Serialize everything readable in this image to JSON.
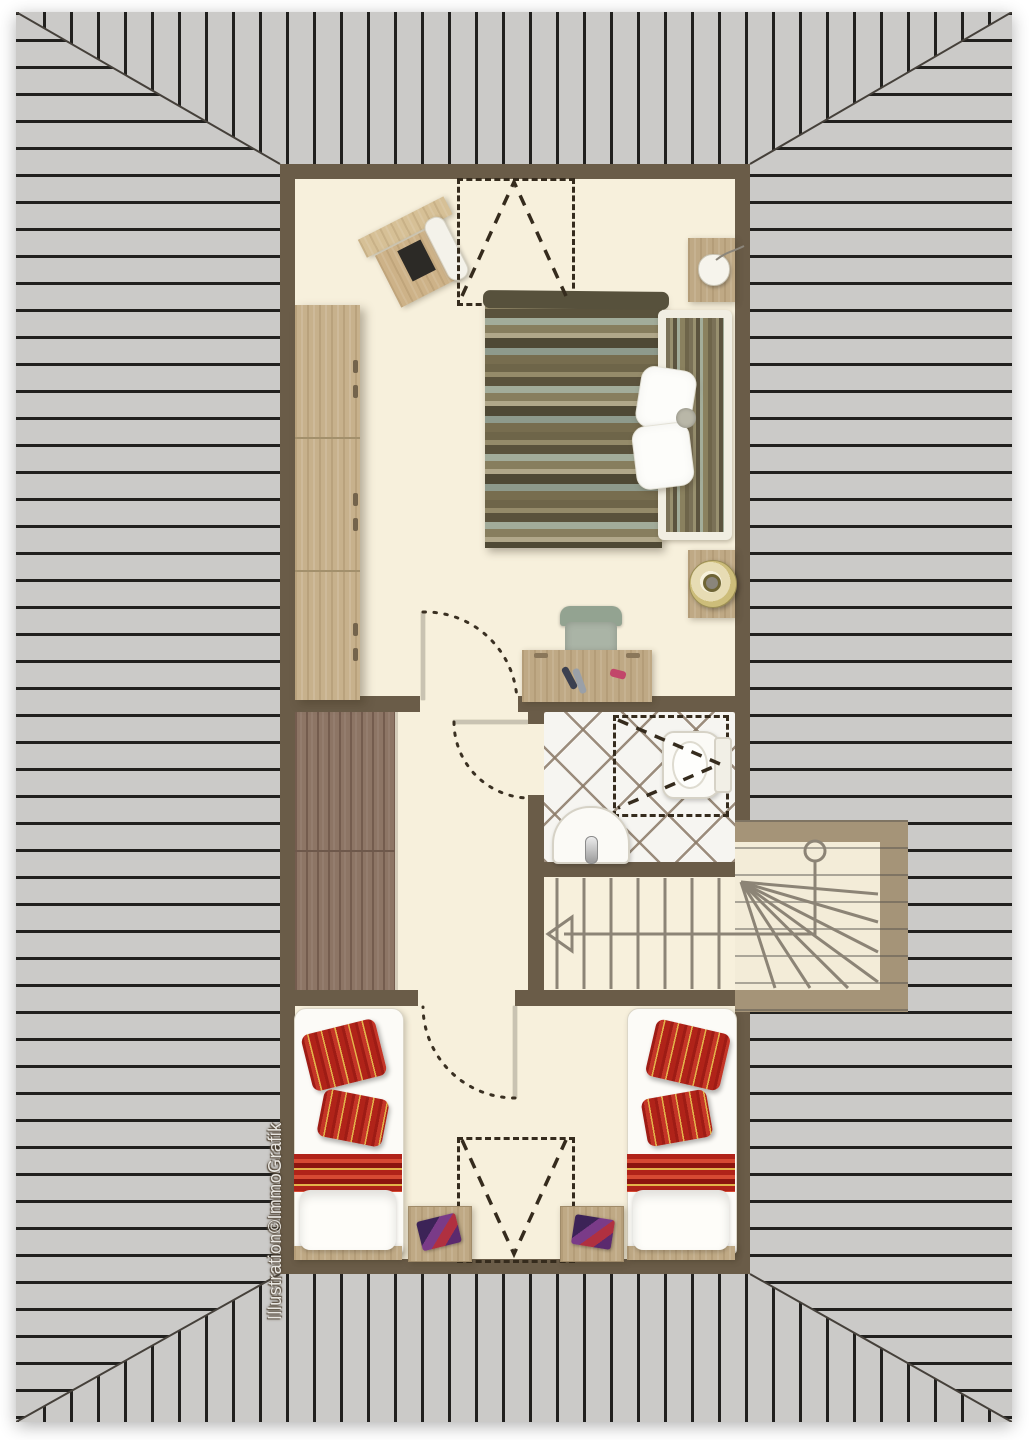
{
  "watermark": {
    "text": "Illustration©ImmoGrafik"
  },
  "plan": {
    "type": "attic floor plan, top view, hip roof",
    "rooms": [
      "bedroom",
      "hallway",
      "closet",
      "bathroom",
      "stairwell",
      "children-bedroom"
    ],
    "symbols": [
      "hip-roof-hatching",
      "roof-window-dashed-bedroom",
      "roof-window-dashed-bathroom",
      "roof-window-dashed-children-room",
      "door-swing-bedroom",
      "door-swing-bathroom",
      "door-swing-children-room",
      "stair-direction-arrow",
      "stair-handrail-with-newel"
    ],
    "furniture": {
      "bedroom": [
        "wardrobe",
        "piano-with-bench",
        "double-bed-striped-duvet",
        "white-pillows",
        "bedside-table-with-small-lamp",
        "bedside-table-with-round-gold-lamp",
        "desk-with-pens",
        "office-chair"
      ],
      "bathroom": [
        "toilet",
        "sink-with-faucet"
      ],
      "children_bedroom": [
        "single-bed-left",
        "single-bed-right",
        "red-striped-pillows",
        "bedside-cabinet-left-with-book",
        "bedside-cabinet-right-with-book"
      ]
    }
  },
  "palette": {
    "page_bg": "#ffffff",
    "roof_bg": "#cbcac8",
    "roof_line": "#21201e",
    "annex_roof_line": "#504e4a",
    "wall": "#6a5c48",
    "annex_wall": "#a59478",
    "floor": "#f7f0dc",
    "wood_light": "#c7b18c",
    "wood_dark": "#8d7565",
    "tile_line": "#8b7a67",
    "stair_line": "#8c8476",
    "dash_symbol": "#352b1d",
    "duvet_olive": "#6e6549",
    "duvet_teal": "#a2ac9a",
    "kids_red": "#b02319",
    "kids_gold": "#e3b34a",
    "lamp_gold": "#cdbd7a"
  }
}
